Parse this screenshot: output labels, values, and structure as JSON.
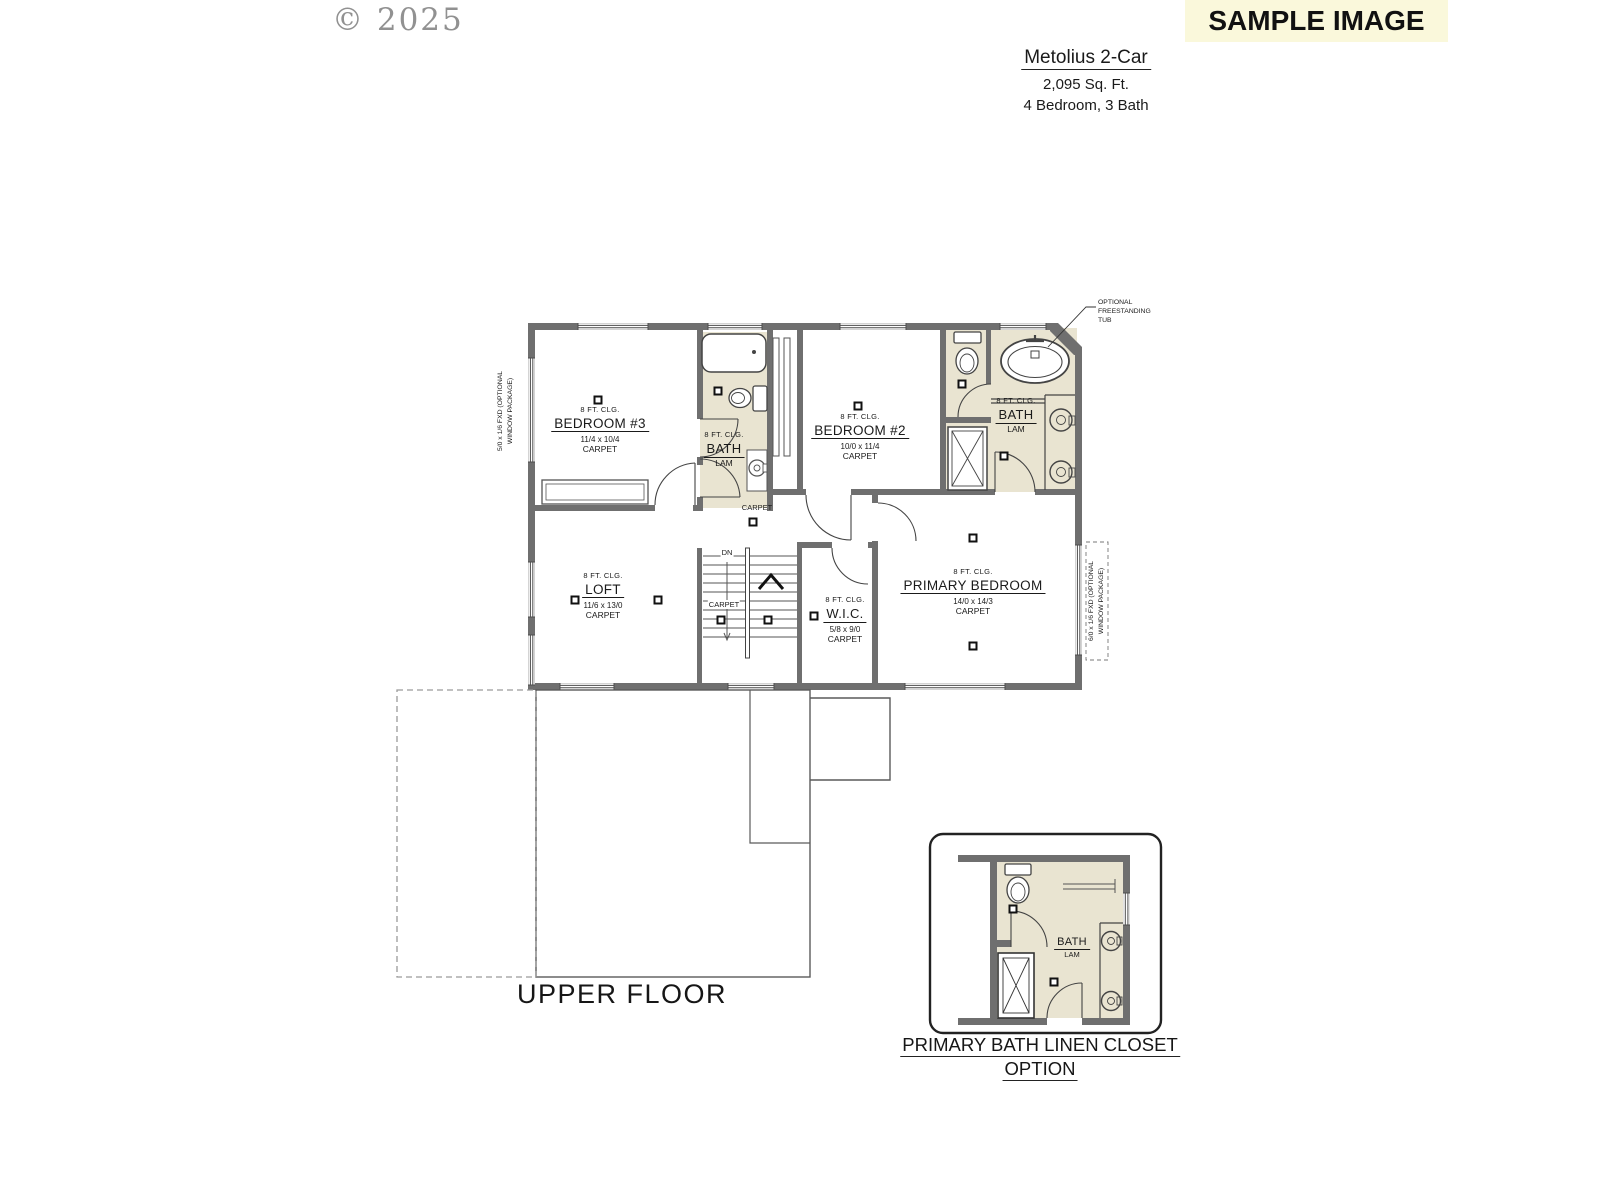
{
  "page": {
    "copyright": "© 2025",
    "sample_banner": "SAMPLE IMAGE"
  },
  "plan_header": {
    "title": "Metolius 2-Car",
    "sqft": "2,095 Sq. Ft.",
    "beds_baths": "4 Bedroom, 3 Bath"
  },
  "floor_plan": {
    "floor_label": "UPPER FLOOR",
    "rooms": [
      {
        "name": "BEDROOM #3",
        "ceiling": "8 FT. CLG.",
        "dims": "11/4 x 10/4",
        "floor": "CARPET"
      },
      {
        "name": "BATH",
        "ceiling": "8 FT. CLG.",
        "floor": "LAM"
      },
      {
        "name": "BEDROOM #2",
        "ceiling": "8 FT. CLG.",
        "dims": "10/0 x 11/4",
        "floor": "CARPET"
      },
      {
        "name": "BATH",
        "ceiling": "8 FT. CLG.",
        "floor": "LAM"
      },
      {
        "name": "LOFT",
        "ceiling": "8 FT. CLG.",
        "dims": "11/6 x 13/0",
        "floor": "CARPET"
      },
      {
        "name": "W.I.C.",
        "ceiling": "8 FT. CLG.",
        "dims": "5/8 x 9/0",
        "floor": "CARPET"
      },
      {
        "name": "PRIMARY BEDROOM",
        "ceiling": "8 FT. CLG.",
        "dims": "14/0 x 14/3",
        "floor": "CARPET"
      }
    ],
    "annotations": {
      "hall_carpet": "CARPET",
      "stairs_carpet": "CARPET",
      "stairs_down": "DN",
      "optional_tub": [
        "OPTIONAL",
        "FREESTANDING",
        "TUB"
      ],
      "window_left": [
        "5/0 x 1/6 FXD (OPTIONAL",
        "WINDOW PACKAGE)"
      ],
      "window_right": [
        "6/0 x 1/6 FXD (OPTIONAL",
        "WINDOW PACKAGE)"
      ]
    }
  },
  "inset": {
    "caption_line1": "PRIMARY BATH LINEN CLOSET",
    "caption_line2": "OPTION",
    "room": {
      "name": "BATH",
      "floor": "LAM"
    }
  },
  "colors": {
    "wall": "#6F6F6F",
    "bath_fill": "#E9E4D1",
    "banner_bg": "#FAF8DB"
  }
}
